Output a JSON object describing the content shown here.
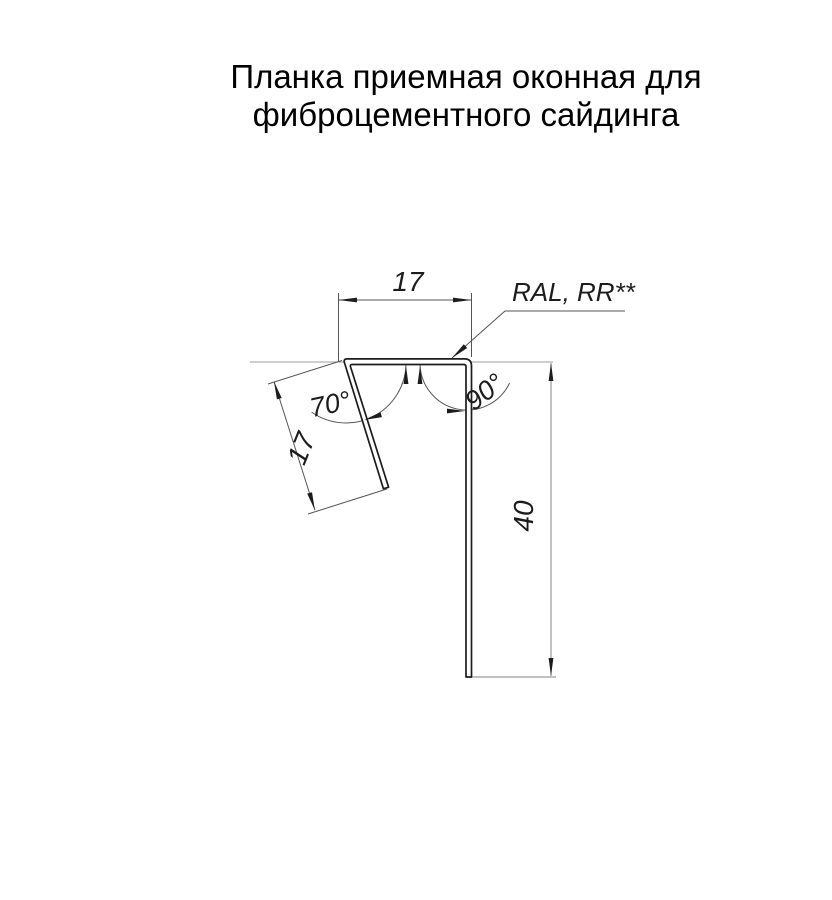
{
  "title": {
    "line1": "Планка приемная оконная для",
    "line2": "фиброцементного сайдинга"
  },
  "drawing": {
    "coating_label": "RAL, RR**",
    "dim_top_width": "17",
    "dim_flange_length": "17",
    "dim_height": "40",
    "angle_flange": "70°",
    "angle_leg": "90°",
    "colors": {
      "outline": "#1c1c1c",
      "thin_line": "#555555",
      "light_line": "#b0b0b0",
      "background": "#ffffff"
    }
  }
}
